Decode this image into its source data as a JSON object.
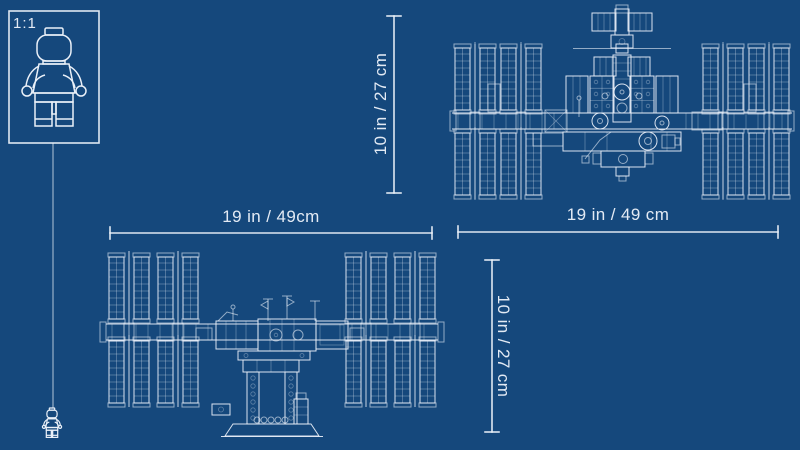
{
  "colors": {
    "background": "#15487C",
    "line": "#EAF0F8"
  },
  "scale_indicator": {
    "label": "1:1"
  },
  "views": {
    "top": {
      "width_label": "19 in / 49 cm",
      "height_label": "10 in / 27 cm"
    },
    "front": {
      "width_label": "19 in / 49cm",
      "height_label": "10 in / 27 cm"
    }
  }
}
